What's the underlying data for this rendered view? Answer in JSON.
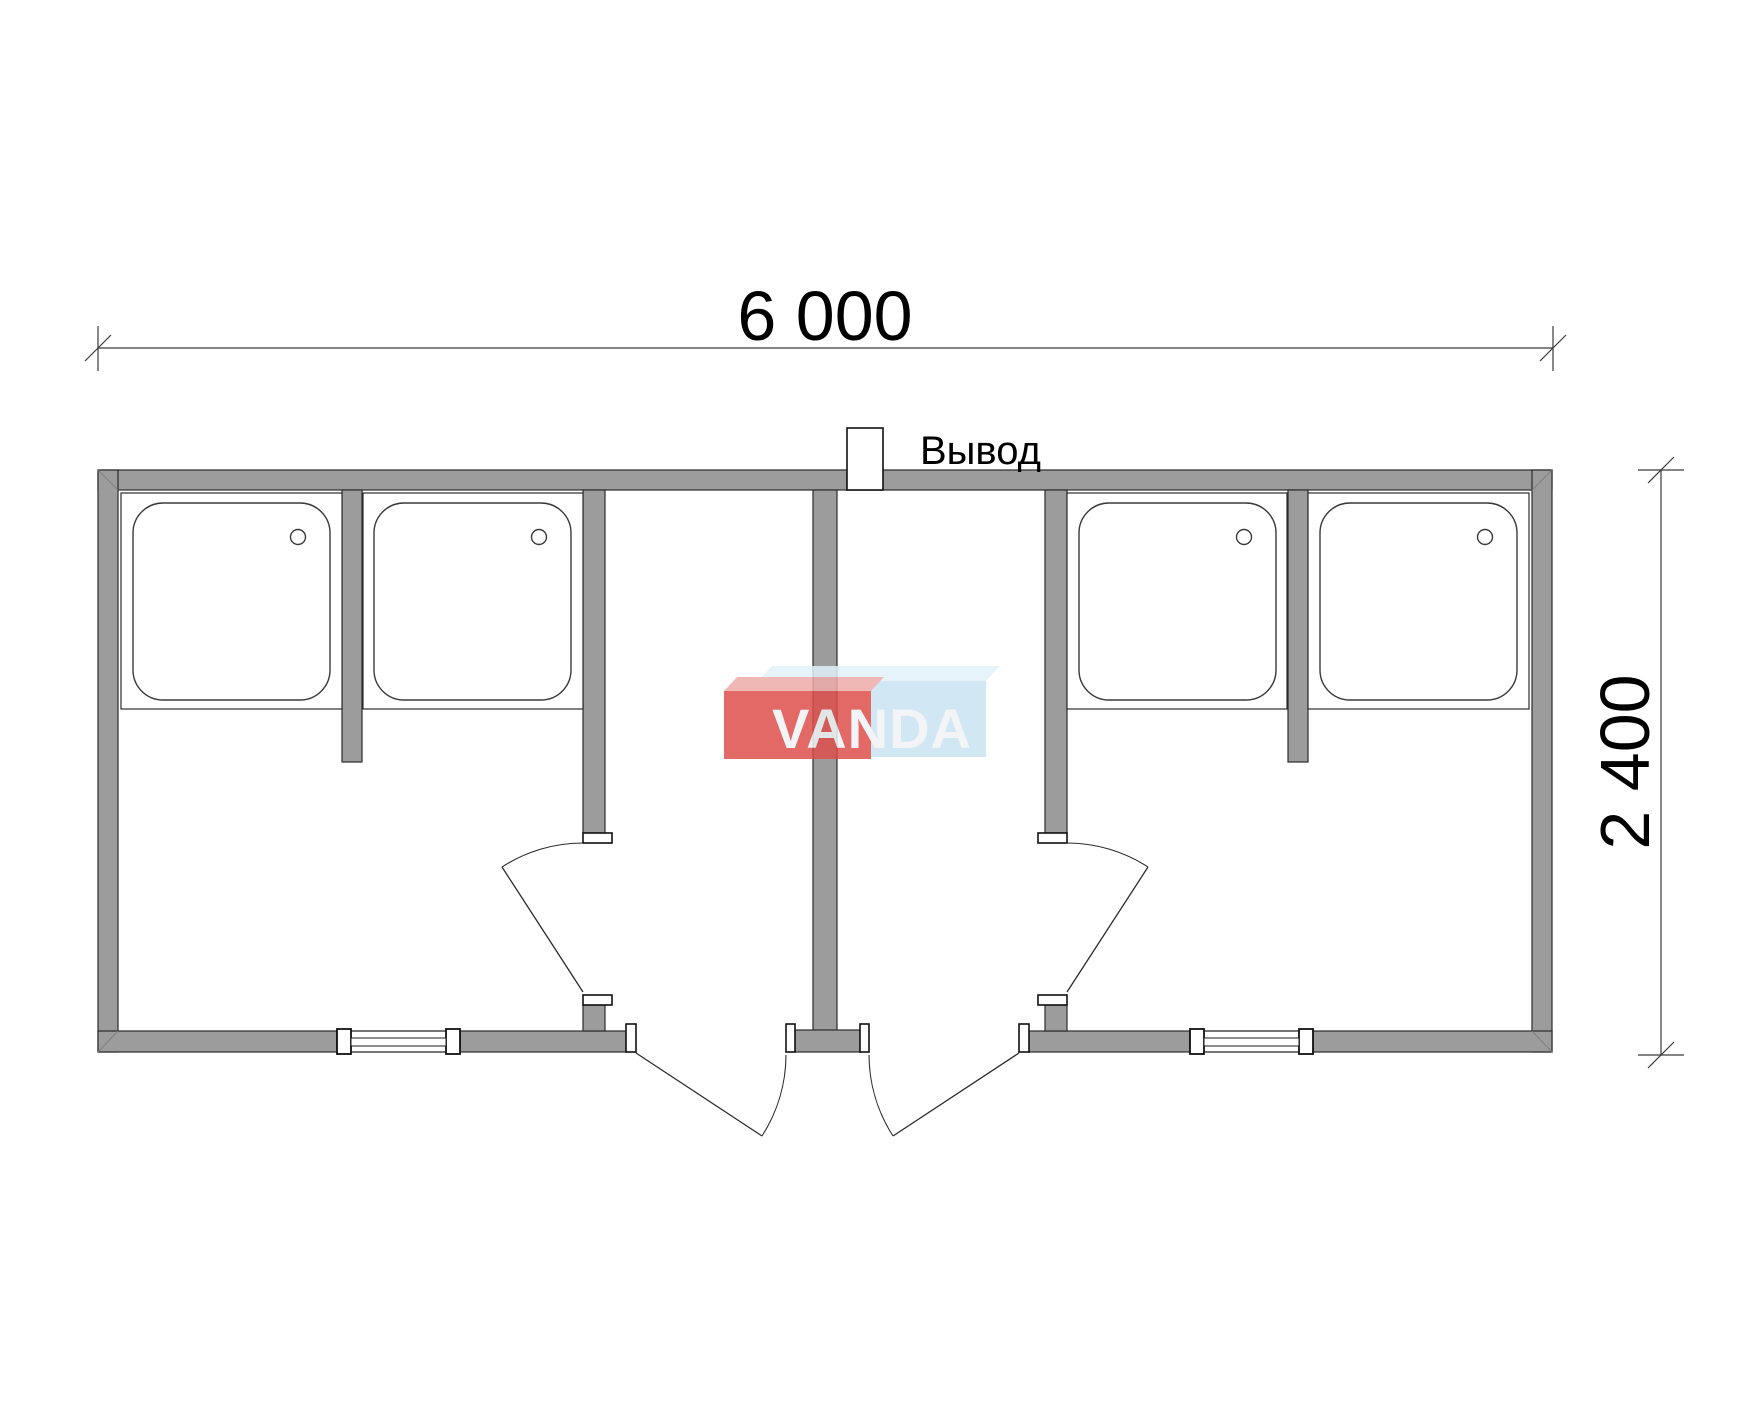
{
  "dimensions": {
    "top": {
      "label": "6 000"
    },
    "right": {
      "label": "2 400"
    }
  },
  "labels": {
    "outlet": "Вывод"
  },
  "watermark": {
    "text": "VANDA",
    "red": "#dd4f4b",
    "red_top": "#eeaca9",
    "blue": "#cbe3f3",
    "blue_top": "#e3f1fa",
    "text_color": "#f0f3f5"
  },
  "colors": {
    "wall_fill": "#9c9c9c",
    "outline": "#2b2b2b",
    "dim_line": "#3a3a3a",
    "background": "#ffffff"
  },
  "plan": {
    "shower_trays_count": 4,
    "interior_doors_count": 2,
    "exterior_doors_count": 2,
    "windows_count": 2
  }
}
